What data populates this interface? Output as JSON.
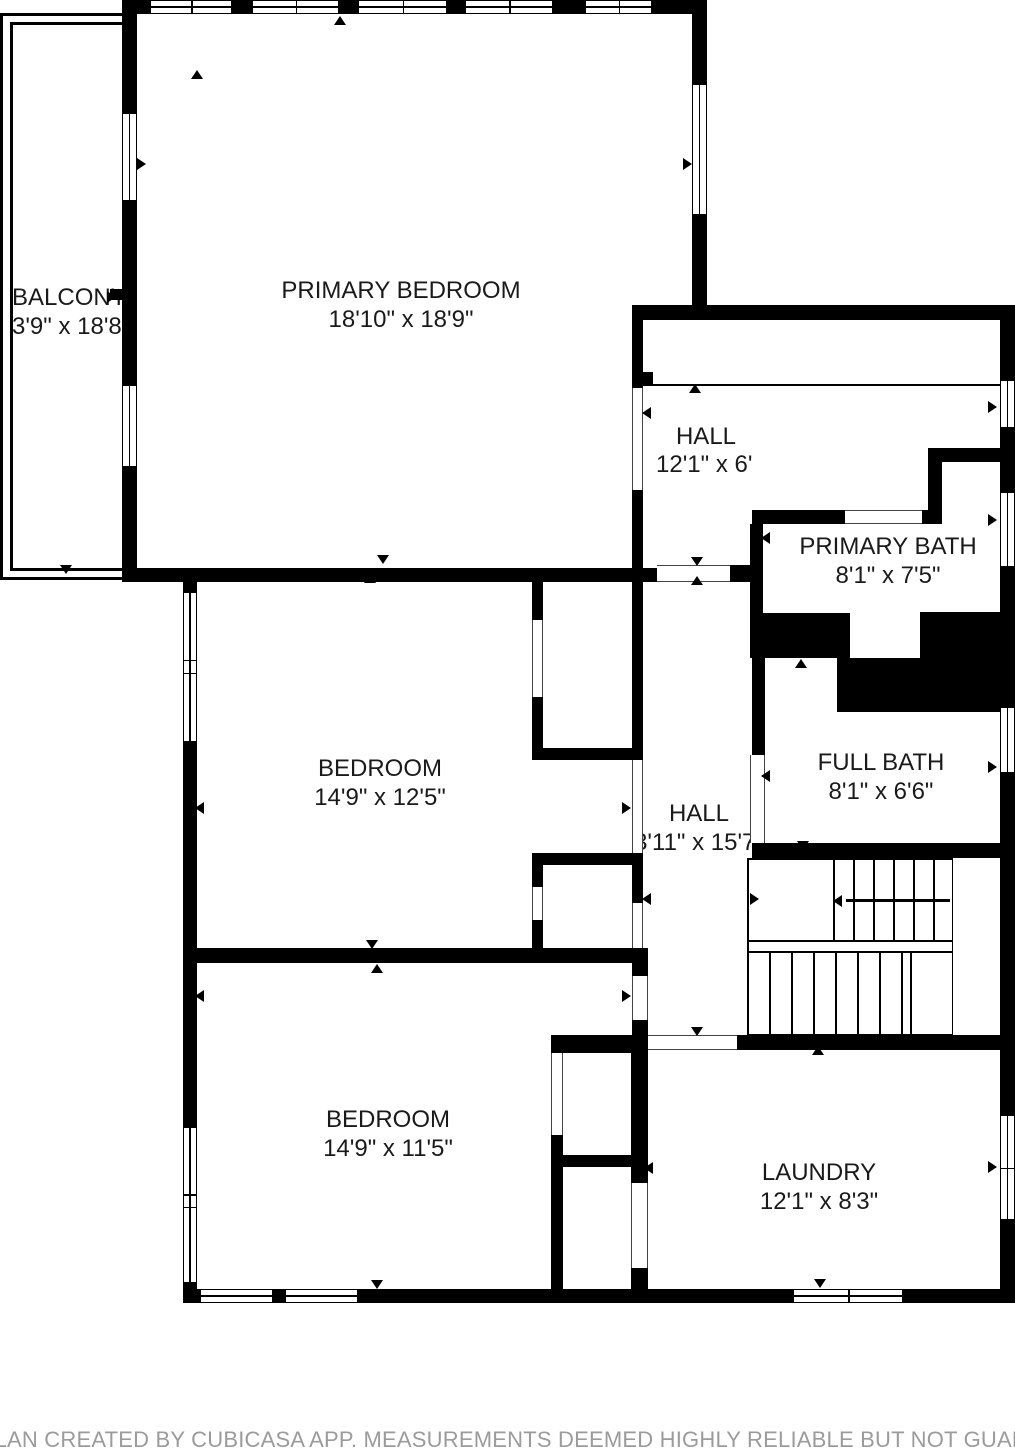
{
  "plan": {
    "rooms": [
      {
        "id": "balcony",
        "name": "BALCONY",
        "dims": "3'9\" x 18'8\""
      },
      {
        "id": "primary-bedroom",
        "name": "PRIMARY BEDROOM",
        "dims": "18'10\" x 18'9\""
      },
      {
        "id": "hall-upper",
        "name": "HALL",
        "dims": "12'1\" x 6'"
      },
      {
        "id": "primary-bath",
        "name": "PRIMARY BATH",
        "dims": "8'1\" x 7'5\""
      },
      {
        "id": "bedroom-middle",
        "name": "BEDROOM",
        "dims": "14'9\" x 12'5\""
      },
      {
        "id": "hall-central",
        "name": "HALL",
        "dims": "3'11\" x 15'7\""
      },
      {
        "id": "full-bath",
        "name": "FULL BATH",
        "dims": "8'1\" x 6'6\""
      },
      {
        "id": "bedroom-bottom",
        "name": "BEDROOM",
        "dims": "14'9\" x 11'5\""
      },
      {
        "id": "laundry",
        "name": "LAUNDRY",
        "dims": "12'1\" x 8'3\""
      }
    ]
  },
  "footer": {
    "disclaimer": "FLOOR PLAN CREATED BY CUBICASA APP. MEASUREMENTS DEEMED HIGHLY RELIABLE BUT NOT GUARANTEED"
  },
  "colors": {
    "wall": "#000000",
    "background": "#ffffff",
    "label_text": "#1a1a1a",
    "footer_text": "#9b9b9b"
  }
}
